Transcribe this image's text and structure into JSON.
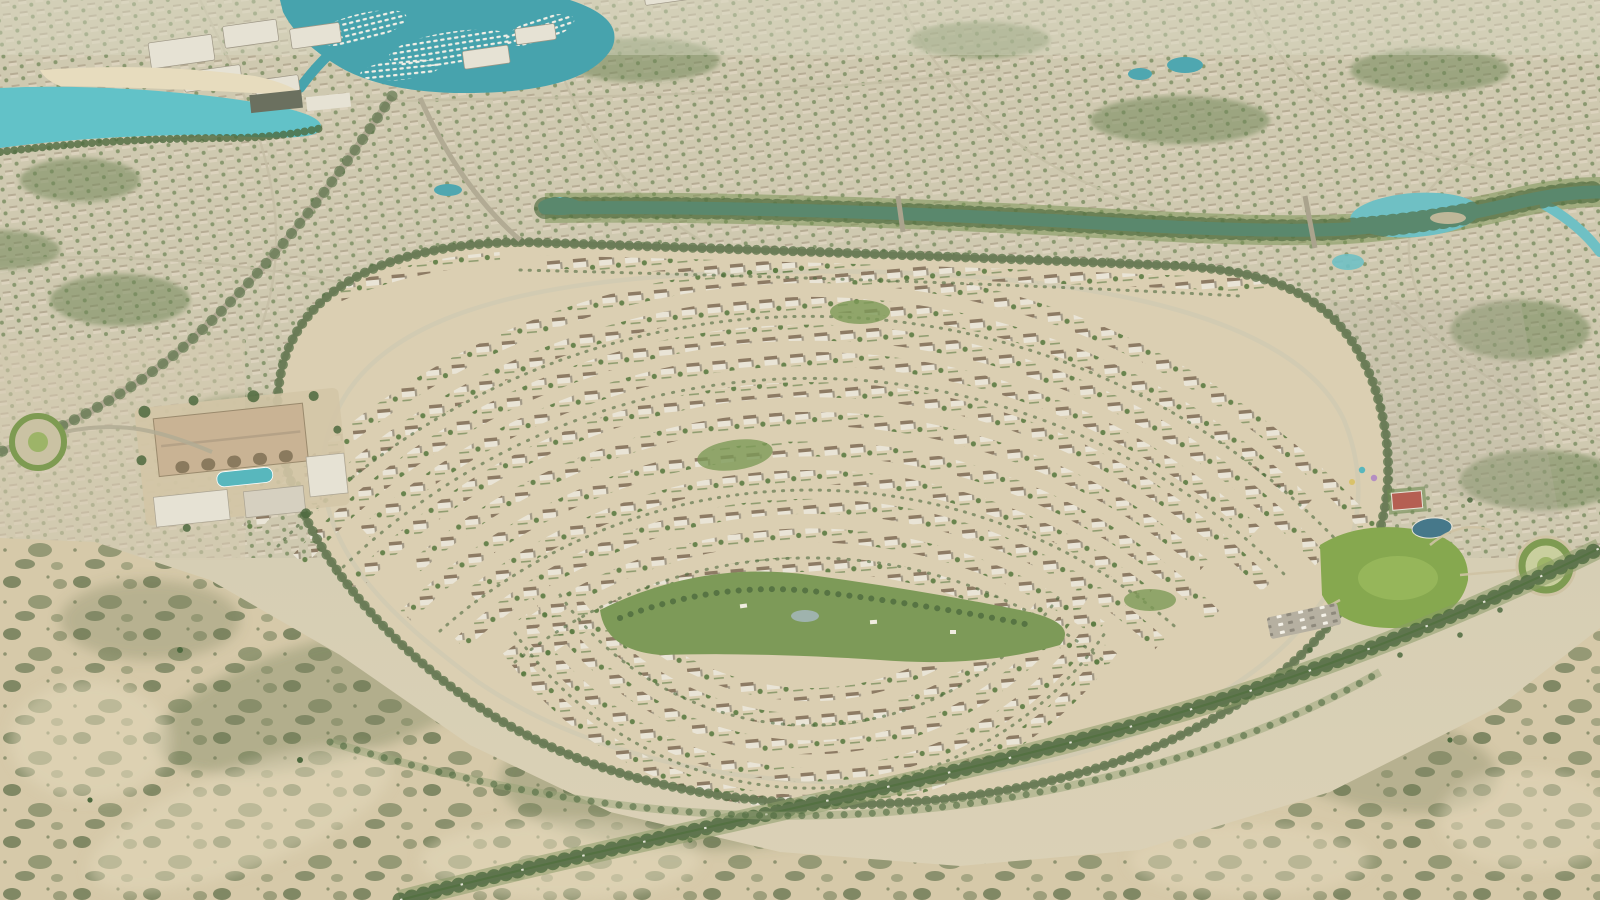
{
  "meta": {
    "title": "Aerial rendering of a master-planned desert villa community",
    "type": "aerial-3d-render",
    "description": "Bird's-eye view of a fan-shaped neighborhood of white villas arranged in concentric curved rows, bordered by a turquoise canal and dense low-rise districts behind, a marina with white yachts and a turquoise lagoon at the top left, a clubhouse with pool on the left, a community park with sports court and roundabout on the right, and open scrub desert with a curving tree-lined boulevard in the foreground.",
    "text_in_image": ""
  },
  "palette": {
    "baseTop": "#c9ccb2",
    "baseMid": "#d4cdb3",
    "baseBottom": "#dbd1b6",
    "horizonHaze": "#d8d6c2",
    "suburbBase": "#cfc9b0",
    "suburbHouse": "#ddd4bf",
    "suburbRoof": "#a89c84",
    "suburbTree": "#73885a",
    "streetLight": "#c6bfa6",
    "marinaWater": "#47a3ad",
    "boatWhite": "#f2efe6",
    "aptWhite": "#e6e2d4",
    "aptShadow": "#9d9685",
    "beachSand": "#e7dcbe",
    "lagoonWater": "#62c2c8",
    "canalWater": "#6fc0c4",
    "canalBank": "#74904d",
    "sandField": "#dbcfb2",
    "villaWhite": "#e9e4d6",
    "villaRoof": "#8d7b64",
    "villaShadow": "#a39a87",
    "villaTree": "#5d7c44",
    "parkGreen": "#7d9a58",
    "lawnGreen": "#86a84f",
    "lawnLight": "#9cbc60",
    "pondGray": "#9fb3ad",
    "roadGray": "#aaa38d",
    "roadAsphalt": "#a7a18c",
    "roadLight": "#cfc9b2",
    "treeDark": "#4e6a3f",
    "treeBand": "#8a9a68",
    "medianGreen": "#6f8c50",
    "clubRoof": "#c9b394",
    "clubGround": "#d3c5a6",
    "clubArch": "#8a7a5e",
    "poolTeal": "#58b7bd",
    "courtRed": "#b55f52",
    "sportsPool": "#46788a",
    "ringGreen": "#7e9b52",
    "ringFill": "#c9cf9e",
    "ringCenter": "#9db468",
    "desertSand": "#d6c9a9",
    "scrubDark": "#5f6e4a",
    "scrubMid": "#77825c",
    "sandLight": "#e4d9bc",
    "parkingGray": "#b6b0a1",
    "grayVillaTint": "#b9b3a3"
  },
  "scene": {
    "regions": [
      {
        "name": "background-suburbs",
        "description": "Dense low-rise villa districts stretching to the horizon with curving streets and small ponds"
      },
      {
        "name": "marina",
        "description": "Marina basin packed with rows of white yachts, top left"
      },
      {
        "name": "apartment-district",
        "description": "Mid-rise white apartment blocks around the marina"
      },
      {
        "name": "lagoon",
        "description": "Turquoise lagoon with a sandy beach edge, top left"
      },
      {
        "name": "canal",
        "description": "Turquoise canal winding across the development with green banks, bridges and a widened basin on the right"
      },
      {
        "name": "central-villa-community",
        "description": "Fan-shaped neighborhood of white villas in concentric curved rows around a green park spine, wrapped by a tree-lined perimeter road"
      },
      {
        "name": "central-park-spine",
        "description": "Linear landscaped park with lawns, trees and a small pond in the middle of the neighborhood"
      },
      {
        "name": "clubhouse",
        "description": "Clubhouse complex with large pitched roof, arched entries and a swimming pool, left of the community"
      },
      {
        "name": "community-park",
        "description": "Community park on the right with lawn, sports court, pool, playground and parking"
      },
      {
        "name": "roundabout",
        "description": "Landscaped roundabouts with green rings at the right park and far left"
      },
      {
        "name": "perimeter-boulevard",
        "description": "Tree-lined boulevard curving between the community edge and the open desert"
      },
      {
        "name": "desert-foreground",
        "description": "Open sandy desert with scattered dark scrub bushes in the foreground"
      }
    ]
  }
}
